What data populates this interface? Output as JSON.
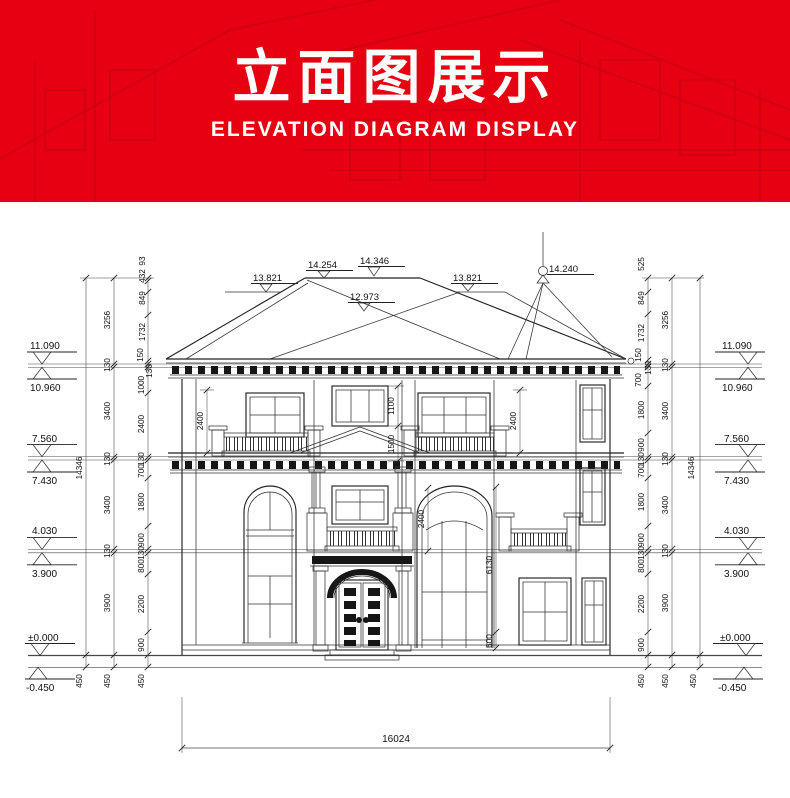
{
  "banner": {
    "title": "立面图展示",
    "subtitle": "ELEVATION DIAGRAM DISPLAY",
    "bg_color": "#e70012"
  },
  "drawing": {
    "roof_marks": {
      "left_13821": "13.821",
      "peak_14254": "14.254",
      "ridge_14346": "14.346",
      "valley_12973": "12.973",
      "right_13821": "13.821",
      "finial_14240": "14.240"
    },
    "levels": {
      "l11090": "11.090",
      "l10960": "10.960",
      "l7560": "7.560",
      "l7430": "7.430",
      "l4030": "4.030",
      "l3900": "3.900",
      "l0": "±0.000",
      "lm450": "-0.450"
    },
    "chains": {
      "total": "14346",
      "mid": [
        "3256",
        "130",
        "3400",
        "130",
        "3400",
        "130",
        "3900"
      ],
      "left_inner": [
        "93",
        "432",
        "849",
        "1732",
        "150",
        "130",
        "1000",
        "2400",
        "130",
        "700",
        "1800",
        "900",
        "130",
        "800",
        "2200",
        "900"
      ],
      "right_inner": [
        "525",
        "849",
        "1732",
        "150",
        "130",
        "700",
        "1800",
        "900",
        "130",
        "700",
        "1800",
        "900",
        "130",
        "800",
        "2200",
        "900"
      ],
      "below_grade": "450",
      "width": "16024"
    },
    "detail_dims": {
      "left2400": "2400",
      "center1100": "1100",
      "center1500": "1500",
      "right2400": "2400",
      "arch2400": "2400",
      "arch6130": "6130",
      "base600": "600"
    }
  }
}
